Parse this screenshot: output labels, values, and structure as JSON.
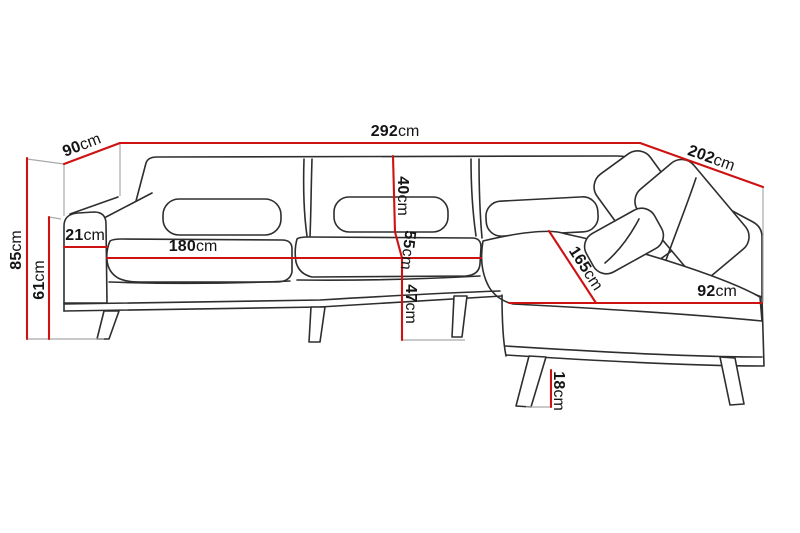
{
  "page": {
    "background": "#ffffff"
  },
  "colors": {
    "dimension_line": "#ce1212",
    "sofa_outline": "#2e2e2e",
    "reference_line": "#a9a9a9",
    "label_text": "#141414"
  },
  "dimensions": [
    {
      "name": "overall-width",
      "value": "292",
      "unit": "cm"
    },
    {
      "name": "left-depth",
      "value": "90",
      "unit": "cm"
    },
    {
      "name": "right-side-length",
      "value": "202",
      "unit": "cm"
    },
    {
      "name": "overall-height",
      "value": "85",
      "unit": "cm"
    },
    {
      "name": "armrest-height",
      "value": "61",
      "unit": "cm"
    },
    {
      "name": "armrest-width",
      "value": "21",
      "unit": "cm"
    },
    {
      "name": "seat-width",
      "value": "180",
      "unit": "cm"
    },
    {
      "name": "backrest-height",
      "value": "40",
      "unit": "cm"
    },
    {
      "name": "mid-section-height",
      "value": "55",
      "unit": "cm"
    },
    {
      "name": "seat-height",
      "value": "47",
      "unit": "cm"
    },
    {
      "name": "chaise-length",
      "value": "165",
      "unit": "cm"
    },
    {
      "name": "chaise-width",
      "value": "92",
      "unit": "cm"
    },
    {
      "name": "leg-height",
      "value": "18",
      "unit": "cm"
    }
  ]
}
